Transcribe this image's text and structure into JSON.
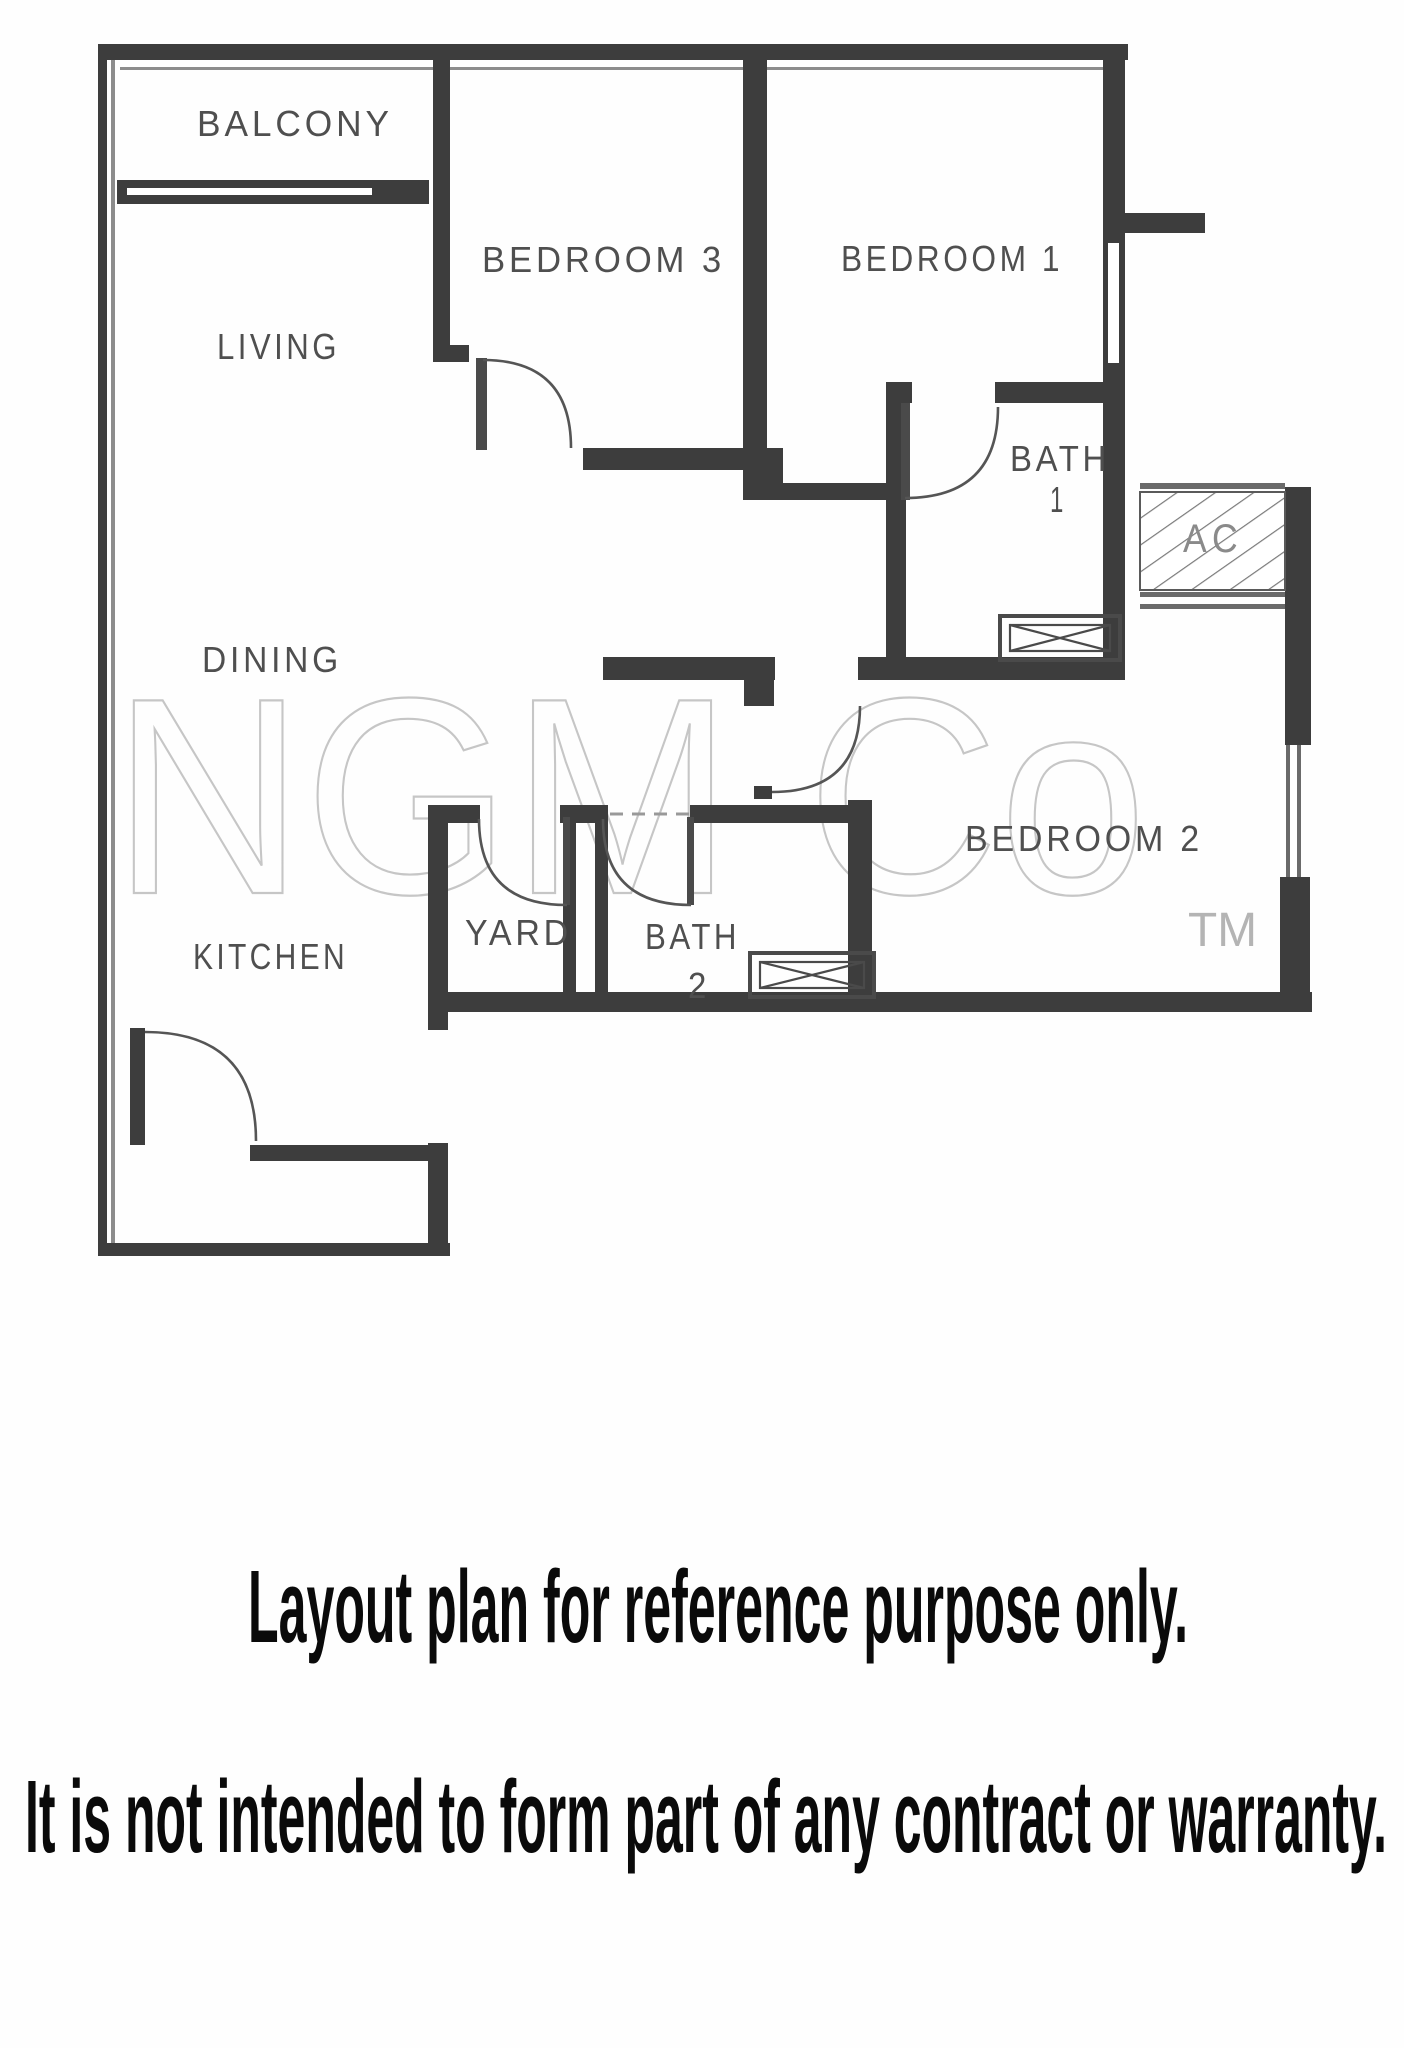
{
  "plan": {
    "rooms": {
      "balcony": {
        "label": "BALCONY"
      },
      "living": {
        "label": "LIVING"
      },
      "bedroom3": {
        "label": "BEDROOM 3"
      },
      "bedroom1": {
        "label": "BEDROOM 1"
      },
      "bath1": {
        "label": "BATH",
        "number": "1"
      },
      "ac": {
        "label": "AC"
      },
      "dining": {
        "label": "DINING"
      },
      "bedroom2": {
        "label": "BEDROOM 2"
      },
      "yard": {
        "label": "YARD"
      },
      "bath2": {
        "label": "BATH",
        "number": "2"
      },
      "kitchen": {
        "label": "KITCHEN"
      }
    },
    "watermark": {
      "text": "NGM Co",
      "tm": "TM"
    },
    "colors": {
      "wall": "#3d3d3d",
      "label": "#4f4f4f",
      "ac_label": "#8a8a8a",
      "watermark": "#c6c6c6",
      "tm": "#b4b4b4",
      "caption": "#0a0a0a",
      "background": "#fefefe"
    }
  },
  "captions": {
    "line1": "Layout plan for reference purpose only.",
    "line2": "It is not intended to form part of any contract or warranty."
  }
}
